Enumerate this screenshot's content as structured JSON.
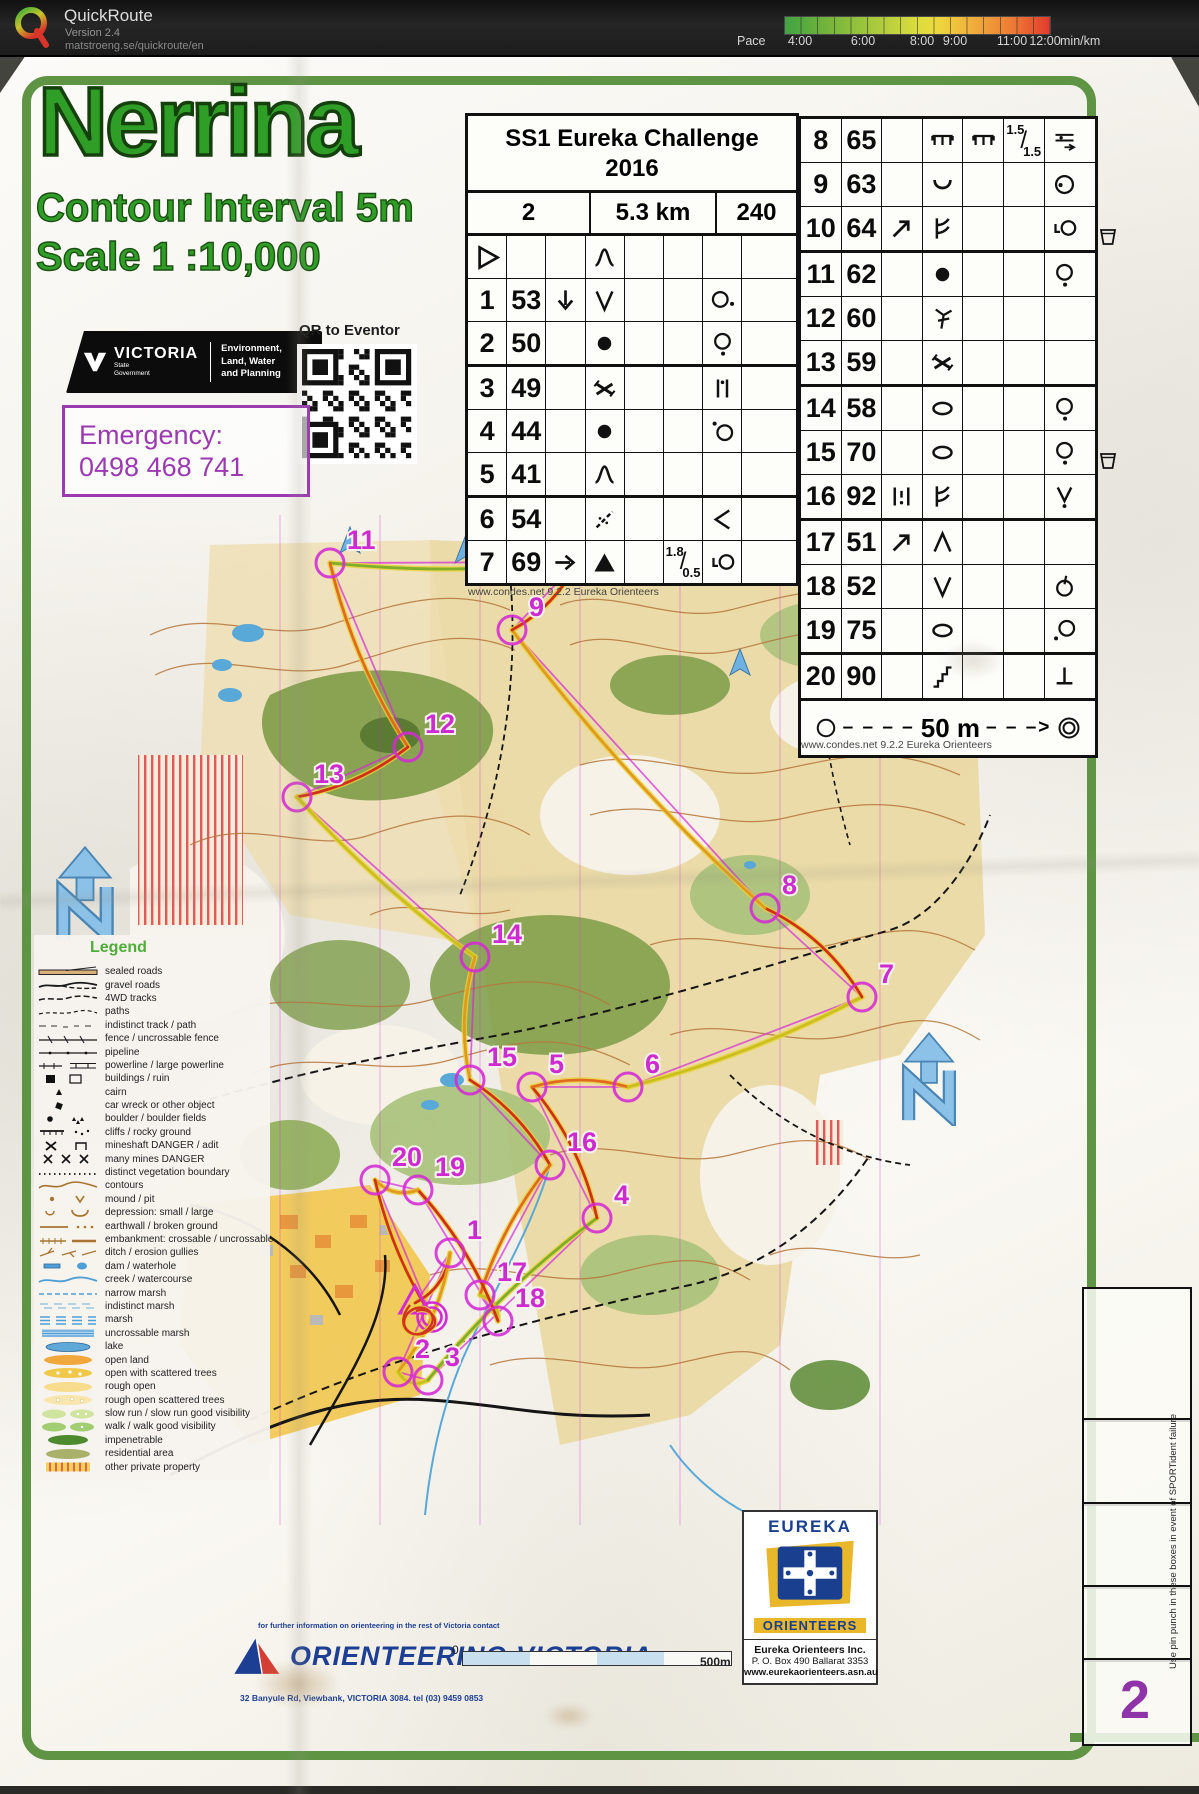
{
  "app": {
    "name": "QuickRoute",
    "version": "Version 2.4",
    "url": "matstroeng.se/quickroute/en",
    "pace": {
      "label": "Pace",
      "unit": "min/km",
      "ticks": [
        "4:00",
        "6:00",
        "8:00",
        "9:00",
        "11:00",
        "12:00"
      ],
      "gradient": [
        "#3fa344",
        "#dcdd3e",
        "#ee9a39",
        "#e13a2d"
      ]
    }
  },
  "sheet": {
    "title": "Nerrina",
    "contour": "Contour Interval 5m",
    "scale": "Scale  1 :10,000",
    "gov": {
      "brand": "VICTORIA",
      "brand_sub1": "State",
      "brand_sub2": "Government",
      "dept_lines": [
        "Environment,",
        "Land, Water",
        "and Planning"
      ]
    },
    "qr_label": "QR to Eventor",
    "emergency": {
      "label": "Emergency:",
      "phone": "0498 468 741"
    }
  },
  "cards": {
    "left": {
      "title1": "SS1 Eureka Challenge",
      "title2": "2016",
      "course": "2",
      "length": "5.3 km",
      "climb": "240",
      "rows": [
        [
          {
            "s": "start"
          },
          {},
          {},
          {
            "s": "hill"
          },
          {},
          {},
          {},
          {}
        ],
        [
          {
            "t": "1"
          },
          {
            "t": "53"
          },
          {
            "s": "arrow-down"
          },
          {
            "s": "v"
          },
          {},
          {},
          {
            "s": "circle-dot-right"
          },
          {}
        ],
        [
          {
            "t": "2"
          },
          {
            "t": "50"
          },
          {},
          {
            "s": "boulder"
          },
          {},
          {},
          {
            "s": "circle-dot-below"
          },
          {}
        ],
        [
          {
            "t": "3"
          },
          {
            "t": "49"
          },
          {},
          {
            "s": "mine"
          },
          {},
          {},
          {
            "s": "between-cliffs"
          },
          {}
        ],
        [
          {
            "t": "4"
          },
          {
            "t": "44"
          },
          {},
          {
            "s": "boulder"
          },
          {},
          {},
          {
            "s": "dot-circle"
          },
          {}
        ],
        [
          {
            "t": "5"
          },
          {
            "t": "41"
          },
          {},
          {
            "s": "hill"
          },
          {},
          {},
          {},
          {}
        ],
        [
          {
            "t": "6"
          },
          {
            "t": "54"
          },
          {},
          {
            "s": "track-cross"
          },
          {},
          {},
          {
            "s": "less"
          },
          {}
        ],
        [
          {
            "t": "7"
          },
          {
            "t": "69"
          },
          {
            "s": "arrow-right"
          },
          {
            "s": "knoll"
          },
          {},
          {
            "fr": [
              "1.8",
              "0.5"
            ]
          },
          {
            "s": "corner-circle"
          },
          {}
        ]
      ],
      "footer": "www.condes.net 9.2.2 Eureka Orienteers"
    },
    "right": {
      "rows": [
        [
          {
            "t": "8"
          },
          {
            "t": "65"
          },
          {},
          {
            "s": "ruin"
          },
          {
            "s": "ruin"
          },
          {
            "fr": [
              "1.5",
              "1.5"
            ]
          },
          {
            "s": "crossing"
          }
        ],
        [
          {
            "t": "9"
          },
          {
            "t": "63"
          },
          {},
          {
            "s": "depression"
          },
          {},
          {},
          {
            "s": "circle-dot-in"
          }
        ],
        [
          {
            "t": "10"
          },
          {
            "t": "64"
          },
          {
            "s": "arrow-ne"
          },
          {
            "s": "spur"
          },
          {},
          {},
          {
            "s": "corner-circle"
          }
        ],
        [
          {
            "t": "11"
          },
          {
            "t": "62"
          },
          {},
          {
            "s": "boulder"
          },
          {},
          {},
          {
            "s": "circle-dot-below"
          }
        ],
        [
          {
            "t": "12"
          },
          {
            "t": "60"
          },
          {},
          {
            "s": "root"
          },
          {},
          {},
          {}
        ],
        [
          {
            "t": "13"
          },
          {
            "t": "59"
          },
          {},
          {
            "s": "mine"
          },
          {},
          {},
          {}
        ],
        [
          {
            "t": "14"
          },
          {
            "t": "58"
          },
          {},
          {
            "s": "ellipse"
          },
          {},
          {},
          {
            "s": "circle-dot-below"
          }
        ],
        [
          {
            "t": "15"
          },
          {
            "t": "70"
          },
          {},
          {
            "s": "ellipse"
          },
          {},
          {},
          {
            "s": "circle-dot-below"
          }
        ],
        [
          {
            "t": "16"
          },
          {
            "t": "92"
          },
          {
            "s": "between-rocks"
          },
          {
            "s": "spur"
          },
          {},
          {},
          {
            "s": "v-dot"
          }
        ],
        [
          {
            "t": "17"
          },
          {
            "t": "51"
          },
          {
            "s": "arrow-ne"
          },
          {
            "s": "peak"
          },
          {},
          {},
          {}
        ],
        [
          {
            "t": "18"
          },
          {
            "t": "52"
          },
          {},
          {
            "s": "v"
          },
          {},
          {},
          {
            "s": "circle-stem"
          }
        ],
        [
          {
            "t": "19"
          },
          {
            "t": "75"
          },
          {},
          {
            "s": "ellipse"
          },
          {},
          {},
          {
            "s": "circle-dot-left"
          }
        ],
        [
          {
            "t": "20"
          },
          {
            "t": "90"
          },
          {},
          {
            "s": "gully"
          },
          {},
          {},
          {
            "s": "dead-tree"
          }
        ]
      ],
      "cup_rows": [
        1,
        6
      ],
      "finish_label": "50 m",
      "footer": "www.condes.net 9.2.2 Eureka Orienteers"
    }
  },
  "legend": {
    "title": "Legend",
    "items": [
      {
        "sw": "sealed",
        "label": "sealed roads"
      },
      {
        "sw": "gravel",
        "label": "gravel roads"
      },
      {
        "sw": "fwd",
        "label": "4WD tracks"
      },
      {
        "sw": "path",
        "label": "paths"
      },
      {
        "sw": "indistinct",
        "label": "indistinct track / path"
      },
      {
        "sw": "fence",
        "label": "fence / uncrossable fence"
      },
      {
        "sw": "pipeline",
        "label": "pipeline"
      },
      {
        "sw": "powerline",
        "label": "powerline / large powerline"
      },
      {
        "sw": "buildings",
        "label": "buildings / ruin"
      },
      {
        "sw": "cairn",
        "label": "cairn"
      },
      {
        "sw": "carwreck",
        "label": "car wreck or other object"
      },
      {
        "sw": "boulderfld",
        "label": "boulder / boulder fields"
      },
      {
        "sw": "cliffs",
        "label": "cliffs / rocky ground"
      },
      {
        "sw": "mineshaft",
        "label": "mineshaft DANGER / adit"
      },
      {
        "sw": "manymines",
        "label": "many mines DANGER"
      },
      {
        "sw": "vegbound",
        "label": "distinct vegetation boundary"
      },
      {
        "sw": "contours",
        "label": "contours"
      },
      {
        "sw": "mound",
        "label": "mound / pit"
      },
      {
        "sw": "depr",
        "label": "depression: small / large"
      },
      {
        "sw": "earthwall",
        "label": "earthwall / broken ground"
      },
      {
        "sw": "embank",
        "label": "embankment: crossable / uncrossable"
      },
      {
        "sw": "ditch",
        "label": "ditch / erosion gullies"
      },
      {
        "sw": "dam",
        "label": "dam / waterhole"
      },
      {
        "sw": "creek",
        "label": "creek / watercourse"
      },
      {
        "sw": "narrowmarsh",
        "label": "narrow marsh"
      },
      {
        "sw": "indmarsh",
        "label": "indistinct marsh"
      },
      {
        "sw": "marsh",
        "label": "marsh"
      },
      {
        "sw": "uncmarsh",
        "label": "uncrossable marsh"
      },
      {
        "sw": "lake",
        "label": "lake"
      },
      {
        "sw": "open",
        "label": "open land"
      },
      {
        "sw": "openscat",
        "label": "open with scattered trees"
      },
      {
        "sw": "rough",
        "label": "rough open"
      },
      {
        "sw": "roughscat",
        "label": "rough open scattered trees"
      },
      {
        "sw": "slowrun",
        "label": "slow run / slow run good visibility"
      },
      {
        "sw": "walk",
        "label": "walk / walk good visibility"
      },
      {
        "sw": "impen",
        "label": "impenetrable"
      },
      {
        "sw": "resid",
        "label": "residential area"
      },
      {
        "sw": "private",
        "label": "other private property"
      }
    ]
  },
  "bottom": {
    "ov_contact": "for further information on orienteering in the rest of Victoria contact",
    "ov_name": "ORIENTEERING VICTORIA",
    "ov_addr": "32 Banyule Rd, Viewbank, VICTORIA 3084. tel (03) 9459 0853",
    "scale0": "0",
    "scale500": "500m",
    "eureka": {
      "top": "EUREKA",
      "bottom": "ORIENTEERS",
      "inc": "Eureka Orienteers Inc.",
      "po": "P. O. Box 490 Ballarat 3353",
      "web": "www.eurekaorienteers.asn.au"
    },
    "punch_note": "Use pin punch in these boxes in event of SPORTident failure",
    "course_no": "2"
  },
  "course": {
    "start": {
      "x": 285,
      "y": 788
    },
    "finish": {
      "x": 302,
      "y": 802
    },
    "controls": [
      {
        "n": "1",
        "x": 320,
        "y": 738
      },
      {
        "n": "2",
        "x": 268,
        "y": 857
      },
      {
        "n": "3",
        "x": 298,
        "y": 865
      },
      {
        "n": "4",
        "x": 467,
        "y": 703
      },
      {
        "n": "5",
        "x": 402,
        "y": 572
      },
      {
        "n": "6",
        "x": 498,
        "y": 572
      },
      {
        "n": "7",
        "x": 732,
        "y": 482
      },
      {
        "n": "8",
        "x": 635,
        "y": 393
      },
      {
        "n": "9",
        "x": 382,
        "y": 115
      },
      {
        "n": "10",
        "x": 447,
        "y": 47
      },
      {
        "n": "11",
        "x": 200,
        "y": 48
      },
      {
        "n": "12",
        "x": 278,
        "y": 232
      },
      {
        "n": "13",
        "x": 167,
        "y": 282
      },
      {
        "n": "14",
        "x": 345,
        "y": 442
      },
      {
        "n": "15",
        "x": 340,
        "y": 565
      },
      {
        "n": "16",
        "x": 420,
        "y": 650
      },
      {
        "n": "17",
        "x": 350,
        "y": 780
      },
      {
        "n": "18",
        "x": 368,
        "y": 806
      },
      {
        "n": "19",
        "x": 288,
        "y": 675
      },
      {
        "n": "20",
        "x": 245,
        "y": 665
      }
    ]
  }
}
